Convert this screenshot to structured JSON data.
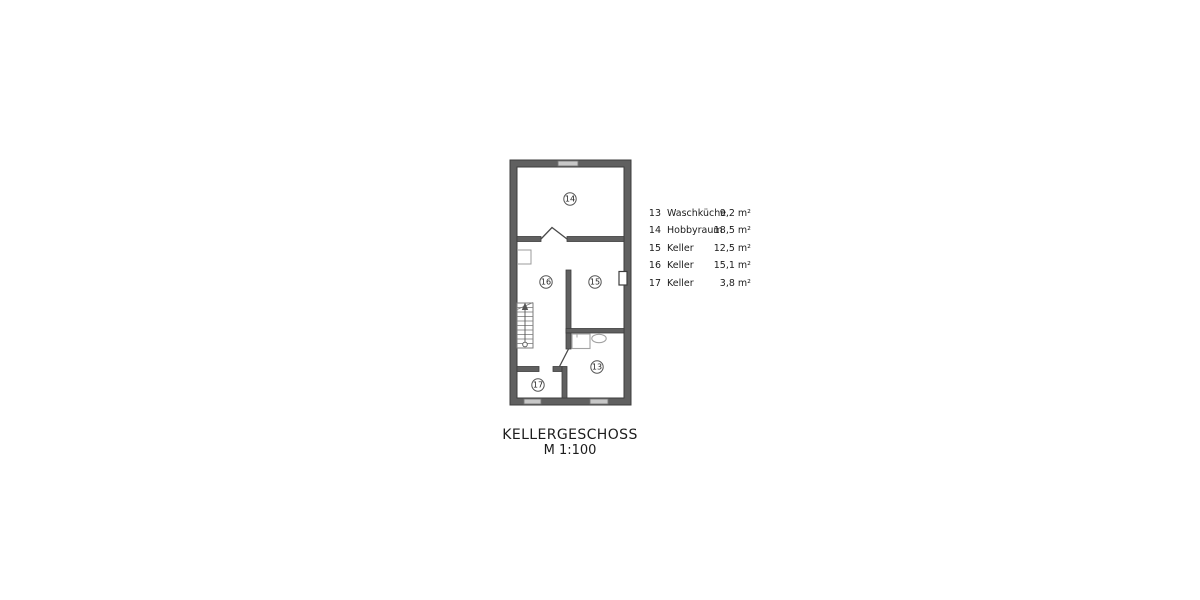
{
  "title": {
    "main": "KELLERGESCHOSS",
    "scale": "M 1:100"
  },
  "legend": {
    "rows": [
      {
        "nr": "13",
        "name": "Waschküche",
        "area": "9,2 m²"
      },
      {
        "nr": "14",
        "name": "Hobbyraum",
        "area": "18,5 m²"
      },
      {
        "nr": "15",
        "name": "Keller",
        "area": "12,5 m²"
      },
      {
        "nr": "16",
        "name": "Keller",
        "area": "15,1 m²"
      },
      {
        "nr": "17",
        "name": "Keller",
        "area": "3,8 m²"
      }
    ]
  },
  "plan": {
    "floor": "Kellergeschoss",
    "scale": "1:100",
    "labels": {
      "r13": "13",
      "r14": "14",
      "r15": "15",
      "r16": "16",
      "r17": "17"
    }
  },
  "colors": {
    "wall_fill": "#606060",
    "wall_outline": "#3d3d3d",
    "window_fill": "#c8c8c8",
    "window_outline": "#777777",
    "fixture_outline": "#a3a3a3",
    "stair_outline": "#7d7d7d",
    "text": "#1c1c1c"
  }
}
